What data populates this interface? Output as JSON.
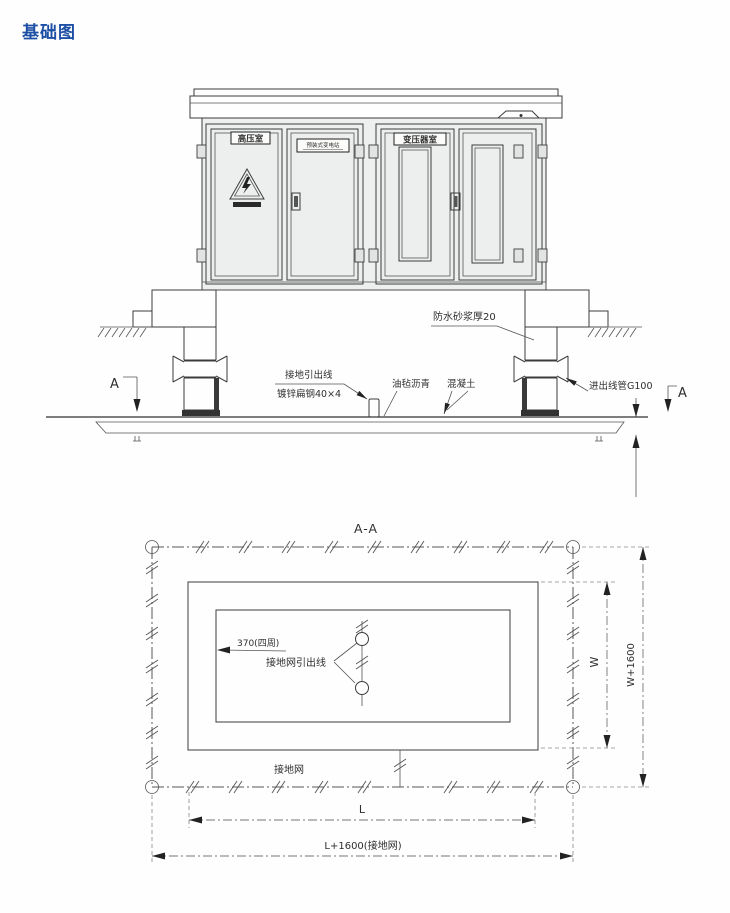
{
  "page": {
    "title": "基础图",
    "title_color": "#1d4fa5"
  },
  "elevation": {
    "cabinet": {
      "room_left_label": "高压室",
      "name_plate_label": "预装式变电站",
      "room_right_label": "变压器室"
    },
    "labels": {
      "waterproof": "防水砂浆厚20",
      "ground_lead_line1": "接地引出线",
      "ground_lead_line2": "镀锌扁钢40×4",
      "asphalt": "油毡沥青",
      "concrete": "混凝土",
      "conduit": "进出线管G100",
      "section_marker": "A",
      "depth_dim": "2500"
    }
  },
  "plan": {
    "title": "A-A",
    "labels": {
      "wall_thickness": "370(四周)",
      "grid_lead": "接地网引出线",
      "grid": "接地网"
    },
    "dims": {
      "length_inner": "L",
      "length_outer": "L+1600(接地网)",
      "width_inner": "W",
      "width_outer": "W+1600"
    }
  },
  "colors": {
    "line": "#3c3c3c",
    "brick_fill": "#ececea",
    "title_blue": "#1d4fa5"
  }
}
